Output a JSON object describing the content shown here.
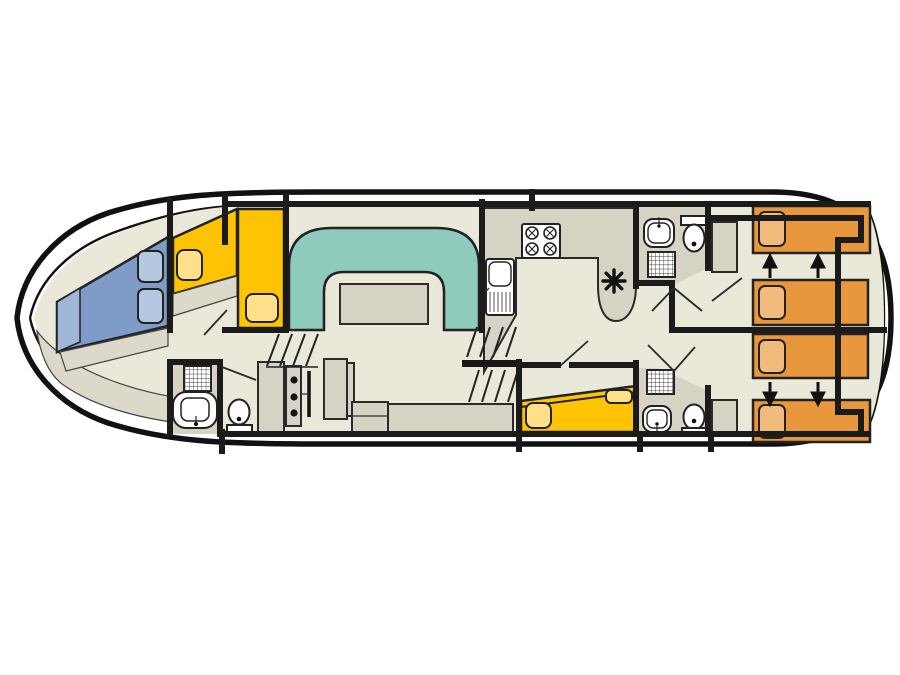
{
  "canvas": {
    "width": 900,
    "height": 675,
    "background": "#ffffff"
  },
  "colors": {
    "background": "#ffffff",
    "hull_line": "#111111",
    "wall": "#1b1b1b",
    "floor": "#eae8d9",
    "furniture_gray": "#d6d3c5",
    "sofa_teal": "#8fcbbc",
    "bed_yellow": "#fec303",
    "pillow_yellow": "#fedf8a",
    "berth_blue": "#7e9cc7",
    "berth_blue_light": "#a0b6d6",
    "pillow_blue": "#b5c8e2",
    "bed_orange": "#e8973d",
    "pillow_orange": "#f1bb7d",
    "fixture_white": "#ffffff"
  },
  "diagram": {
    "type": "boat-floorplan",
    "rooms": [
      {
        "name": "bow-cabin",
        "contents": "v-berth with two pillows"
      },
      {
        "name": "fore-cabin",
        "contents": "two single berths"
      },
      {
        "name": "fore-bathroom",
        "contents": "shower, washbasin, toilet"
      },
      {
        "name": "saloon",
        "contents": "u-shaped sofa, table, helm console, steering wheel, helm seat, bench"
      },
      {
        "name": "galley",
        "contents": "counter, stove, sink, heater marker"
      },
      {
        "name": "mid-bathroom-top",
        "contents": "washbasin, toilet, shower"
      },
      {
        "name": "mid-cabin",
        "contents": "double bed with two pillows"
      },
      {
        "name": "mid-bathroom-bottom",
        "contents": "shower, washbasin, toilet"
      },
      {
        "name": "aft-cabin-port",
        "contents": "two sliding single beds, wardrobe"
      },
      {
        "name": "aft-cabin-starboard",
        "contents": "two sliding single beds, wardrobe"
      }
    ],
    "fixture_glyphs": [
      "v-berth",
      "single-berth",
      "double-bed",
      "sliding-bed",
      "pillow",
      "dinette-sofa",
      "dinette-table",
      "galley-counter",
      "stove-4-burners",
      "galley-sink",
      "shower-grid",
      "washbasin",
      "toilet",
      "wardrobe",
      "cabinet",
      "helm-console",
      "steering-wheel",
      "helm-seat",
      "bench-seat",
      "stairs",
      "heater-asterisk",
      "slide-arrow-up",
      "slide-arrow-down"
    ],
    "aft_bed_count": 4,
    "slide_arrow_up_count": 2,
    "slide_arrow_down_count": 2
  }
}
